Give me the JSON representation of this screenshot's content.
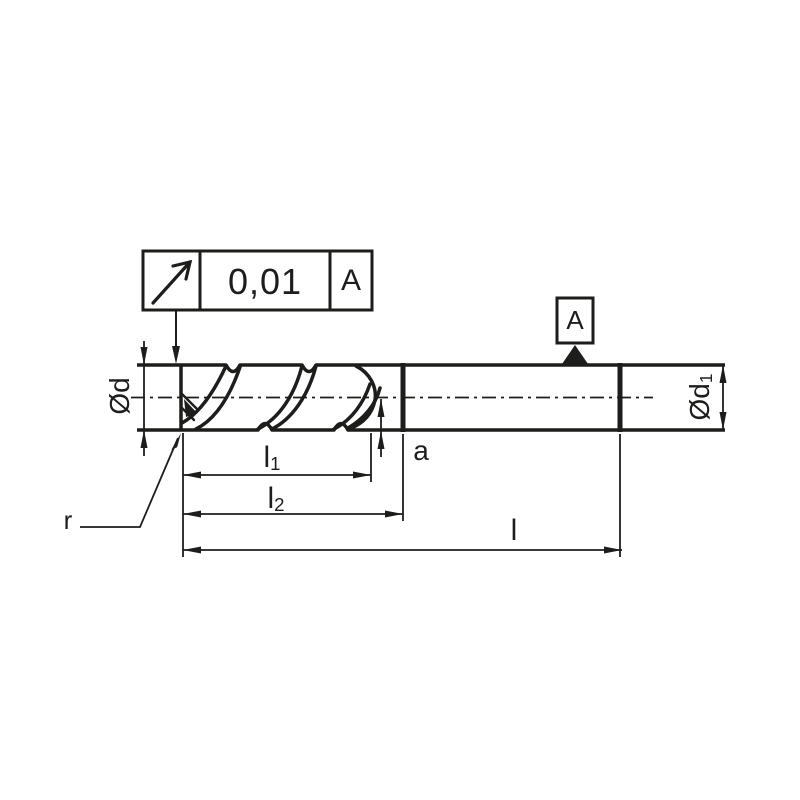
{
  "colors": {
    "ink": "#1d1d1b",
    "background": "#ffffff"
  },
  "tolerance_frame": {
    "symbol_icon": "circular-runout-arrow-icon",
    "value": "0,01",
    "datum_ref": "A"
  },
  "datum_marker": {
    "label": "A"
  },
  "dimensions": {
    "cutting_diameter": {
      "label": "Ød"
    },
    "shank_diameter": {
      "base": "Ød",
      "sub": "1"
    },
    "flute_length": {
      "base": "l",
      "sub": "1"
    },
    "cut_length": {
      "base": "l",
      "sub": "2"
    },
    "overall_length": {
      "label": "l"
    },
    "a_dimension": {
      "label": "a"
    },
    "corner_radius": {
      "label": "r"
    }
  }
}
